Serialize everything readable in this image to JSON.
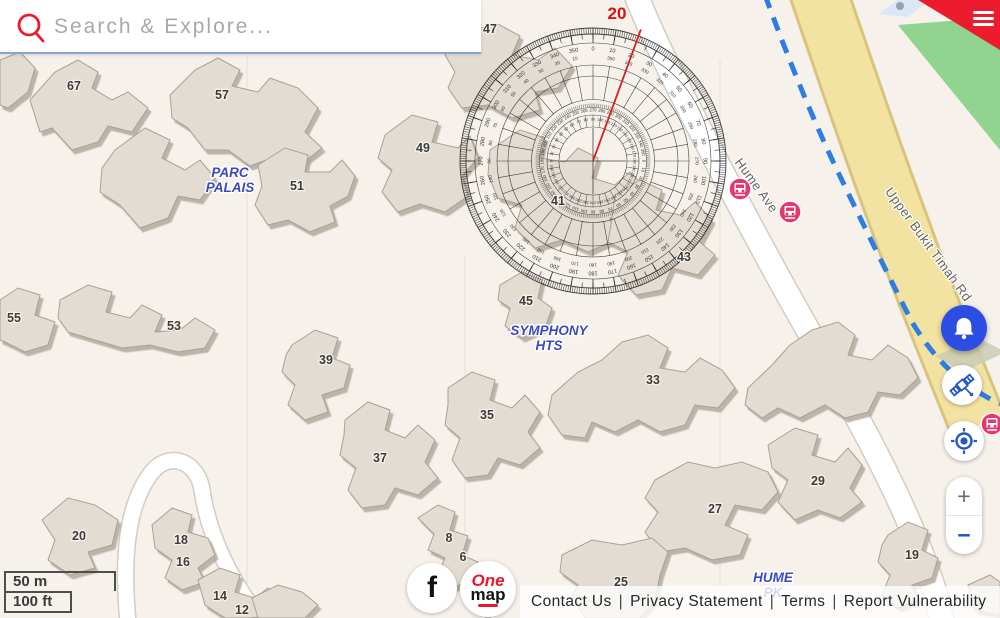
{
  "search": {
    "placeholder": "Search & Explore..."
  },
  "map": {
    "measure_angle": "20",
    "buildings": [
      {
        "label": "67",
        "x": 74,
        "y": 90
      },
      {
        "label": "57",
        "x": 222,
        "y": 99
      },
      {
        "label": "51",
        "x": 297,
        "y": 190
      },
      {
        "label": "49",
        "x": 423,
        "y": 152
      },
      {
        "label": "47",
        "x": 490,
        "y": 33
      },
      {
        "label": "41",
        "x": 558,
        "y": 205
      },
      {
        "label": "43",
        "x": 684,
        "y": 261
      },
      {
        "label": "45",
        "x": 526,
        "y": 305
      },
      {
        "label": "55",
        "x": 14,
        "y": 322
      },
      {
        "label": "53",
        "x": 174,
        "y": 330
      },
      {
        "label": "39",
        "x": 326,
        "y": 364
      },
      {
        "label": "37",
        "x": 380,
        "y": 462
      },
      {
        "label": "35",
        "x": 487,
        "y": 419
      },
      {
        "label": "33",
        "x": 653,
        "y": 384
      },
      {
        "label": "27",
        "x": 715,
        "y": 513
      },
      {
        "label": "29",
        "x": 818,
        "y": 485
      },
      {
        "label": "19",
        "x": 912,
        "y": 559
      },
      {
        "label": "20",
        "x": 79,
        "y": 540
      },
      {
        "label": "18",
        "x": 181,
        "y": 544
      },
      {
        "label": "16",
        "x": 183,
        "y": 566
      },
      {
        "label": "14",
        "x": 220,
        "y": 600
      },
      {
        "label": "12",
        "x": 242,
        "y": 614
      },
      {
        "label": "8",
        "x": 449,
        "y": 542
      },
      {
        "label": "6",
        "x": 463,
        "y": 561
      },
      {
        "label": "25",
        "x": 621,
        "y": 586
      }
    ],
    "areas": [
      {
        "lines": [
          "PARC",
          "PALAIS"
        ],
        "x": 230,
        "y": 177
      },
      {
        "lines": [
          "SYMPHONY",
          "HTS"
        ],
        "x": 549,
        "y": 335
      },
      {
        "lines": [
          "HUME",
          "PK"
        ],
        "x": 773,
        "y": 582
      }
    ],
    "roads": [
      {
        "label": "Hume Ave",
        "x": 753,
        "y": 188,
        "rot": 54
      },
      {
        "label": "Upper Bukit Timah Rd",
        "x": 925,
        "y": 247,
        "rot": 54
      }
    ]
  },
  "controls": {
    "zoom_in": "+",
    "zoom_out": "−"
  },
  "scale": {
    "metric": "50 m",
    "imperial": "100 ft"
  },
  "footer": {
    "links": [
      "Contact Us",
      "Privacy Statement",
      "Terms",
      "Report Vulnerability"
    ],
    "separator": "|"
  },
  "logos": {
    "facebook": "f",
    "onemap_line1": "One",
    "onemap_line2": "map"
  }
}
